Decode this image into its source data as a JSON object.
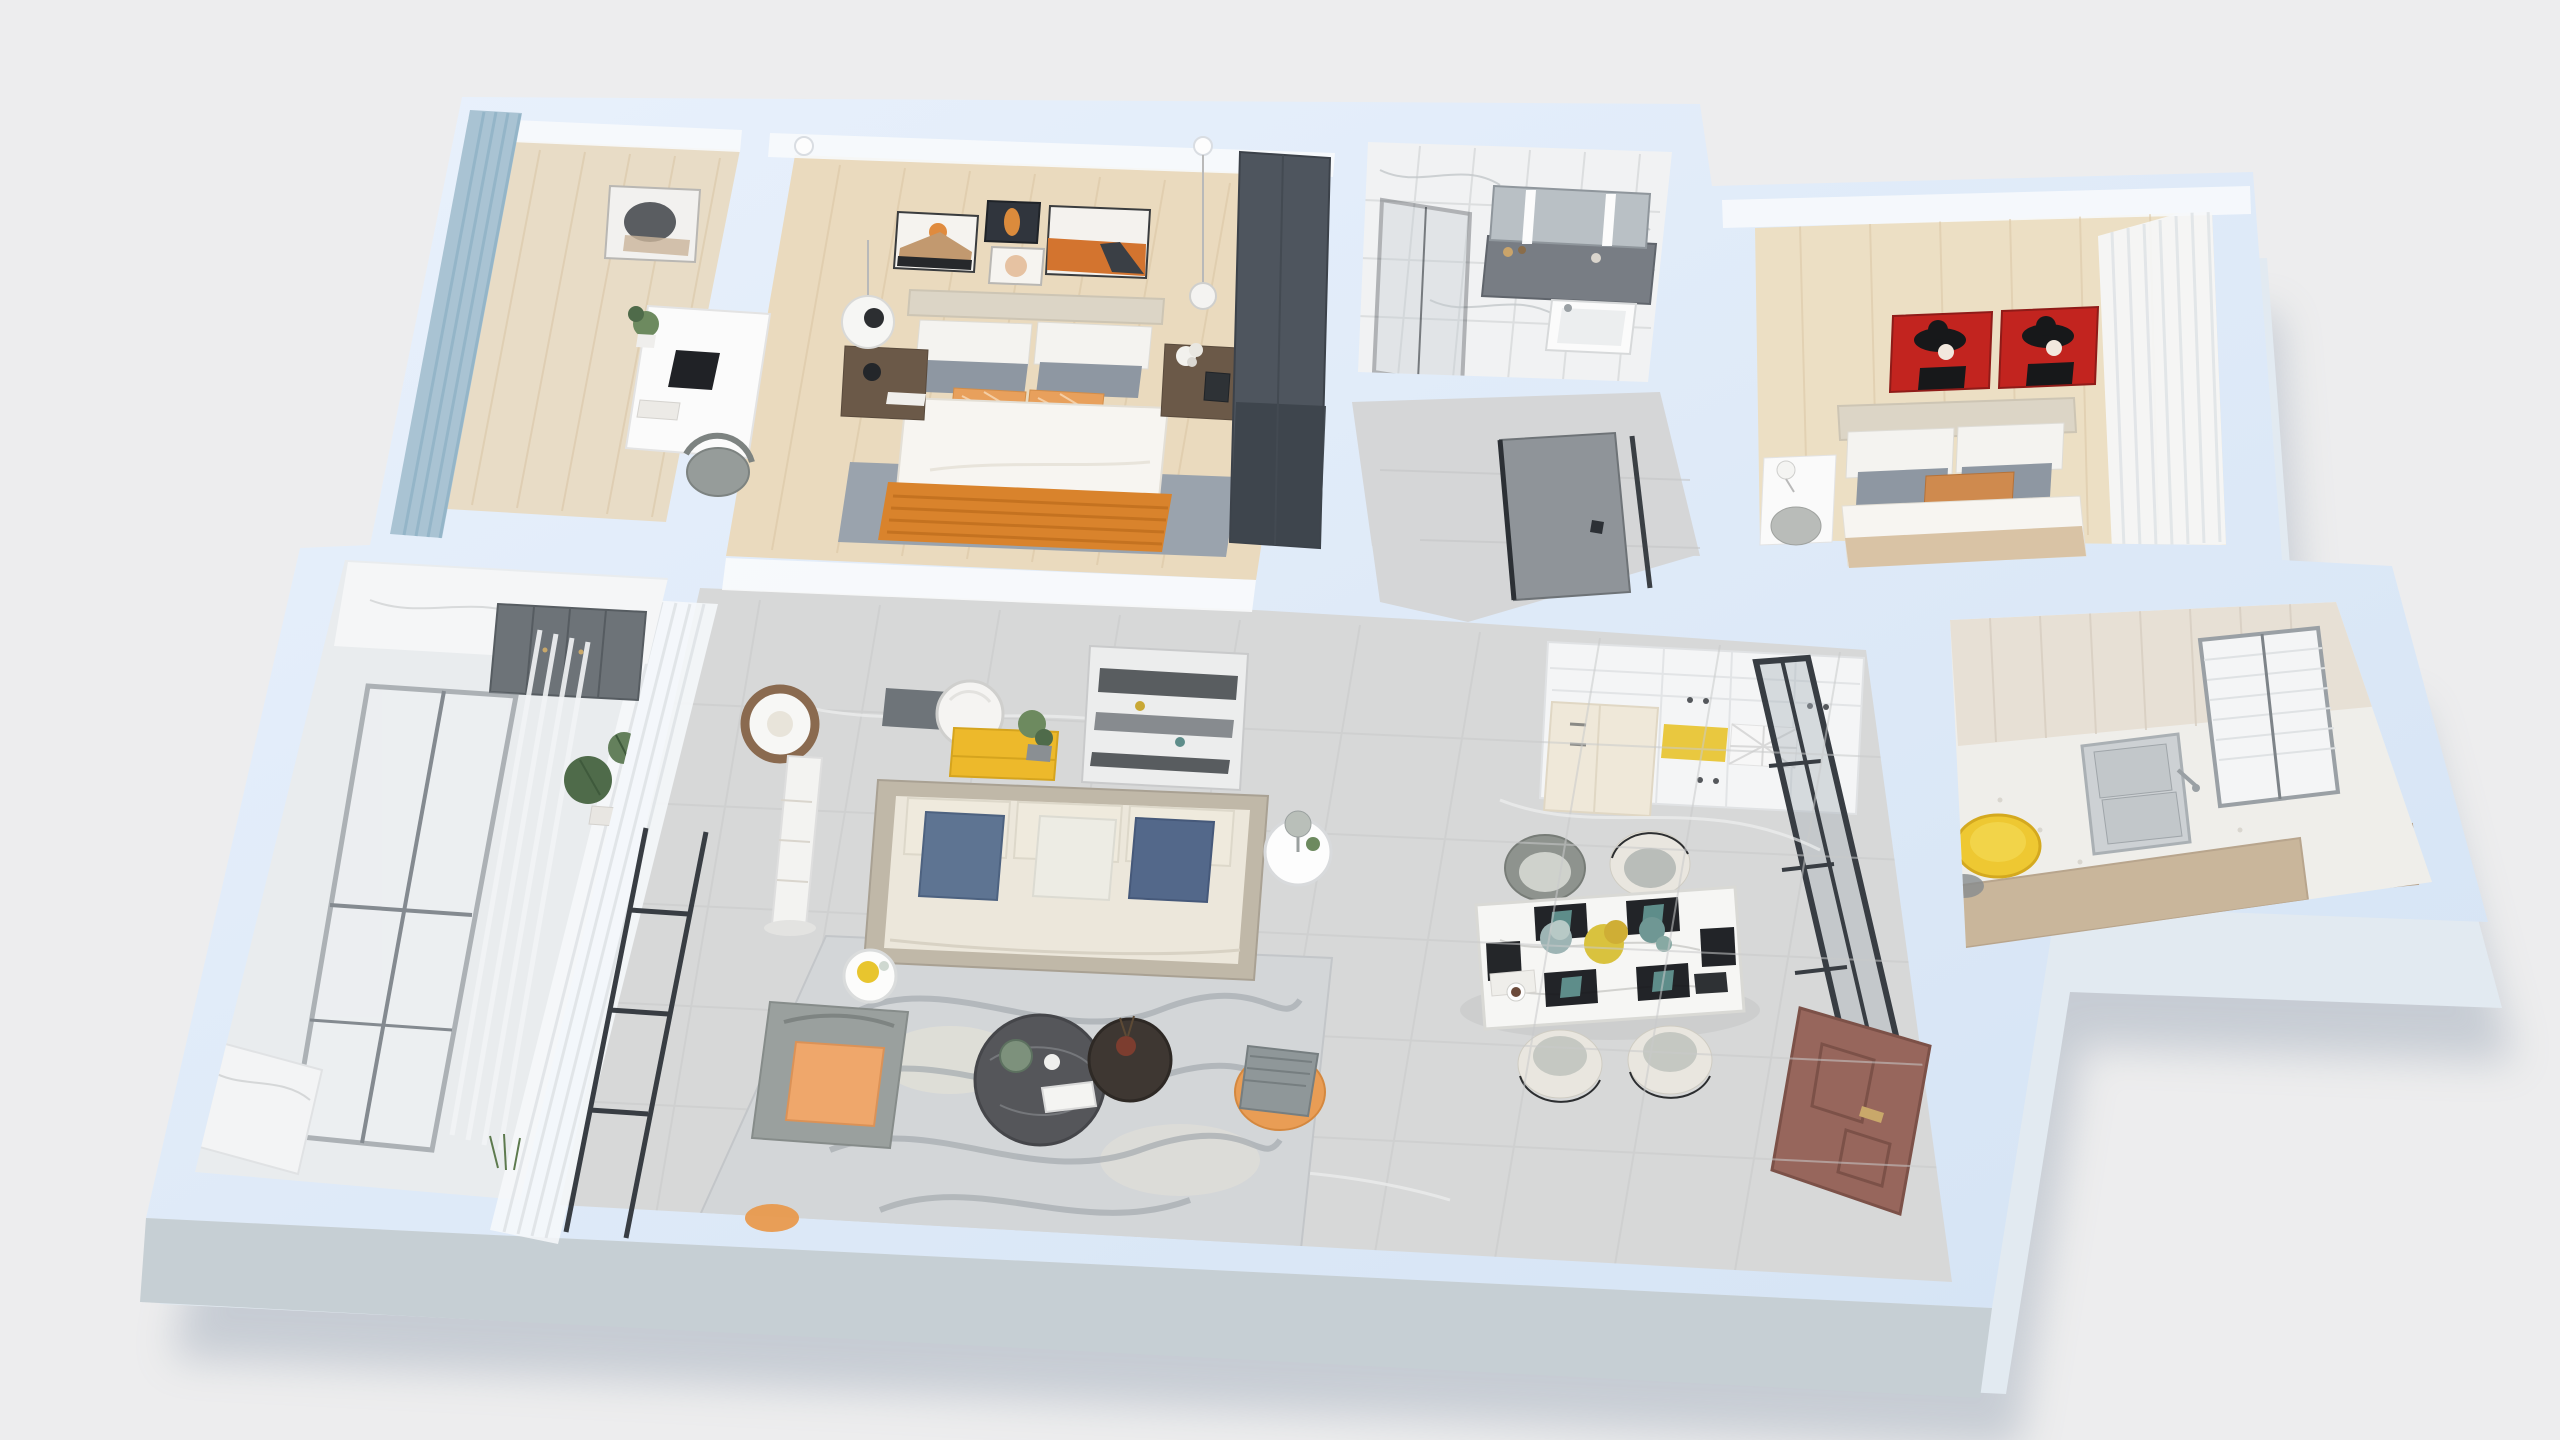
{
  "scene": {
    "kind": "3d-floor-plan-render",
    "view": "isometric top-down apartment rendering",
    "background": "#ededee"
  },
  "palette": {
    "background": "#ededee",
    "wallTopA": "#e9f1fc",
    "wallTopB": "#d4e3f4",
    "wallFace": "#e2eaf1",
    "frontBand": "#c6cfd4",
    "shadow": "#9aa6b5",
    "woodStudy": "#e8dcc6",
    "woodMaster": "#eadabe",
    "woodBedroom2": "#ecdfc4",
    "tile": "#d7d8d8",
    "hallTile": "#d5d6d7",
    "balconyFloor": "#e9ecee",
    "utilityFloor": "#efeeea",
    "marble": "#f1f2f3",
    "curtainBlue": "#a9c3d3",
    "curtainSheer": "rgba(246,248,250,0.88)",
    "wardrobe": "#4e555e",
    "headboard": "#dcd5c6",
    "duvet": "#f7f5f1",
    "pillowGray": "#8e97a2",
    "pillowOrange": "#e8a05c",
    "throwOrange": "#d9832c",
    "rugMaster": "#9aa3ad",
    "rugLiving": "#d3d6d8",
    "rugSwirl": "#a5abb0",
    "sofaShell": "#c0b8a8",
    "sofaBody": "#ece7db",
    "pillowBlue": "#5e7492",
    "pillowBlue2": "#53688a",
    "pillowWhite": "#edece4",
    "consoleYellow": "#edb92b",
    "nicheYellow": "#e9c83f",
    "stoolYellow": "#eec832",
    "plateYellow": "#e8c52e",
    "artRed": "#c2241f",
    "doorBrown": "#97665c",
    "doorGray": "#8f9499",
    "glassFrame": "#383d43",
    "glassPane": "rgba(168,177,185,0.4)",
    "armchair": "#9aa09e",
    "armchairCushion": "#efa76b",
    "pouf": "#e99d55",
    "counterWood": "#c9b69b",
    "steel": "#cdd1d4",
    "tableMarble": "#f6f6f4",
    "chairCream": "#e9e6df",
    "chairSeat": "#b9bdb9",
    "plantGreen": "#4f6b4a",
    "plantLight": "#6d8a5f",
    "lampWood": "#8a6a4f",
    "cabinetWhite": "#f4f5f6",
    "fridgeCream": "#efe8d9",
    "darkPanel": "#6e7479",
    "vanity": "#787d84",
    "mirrorGray": "#b9c0c5"
  },
  "rooms": [
    {
      "id": "study-bedroom",
      "floor": "light wood",
      "furniture": [
        "blue-curtain",
        "window",
        "desk",
        "laptop",
        "chair",
        "wall-art",
        "plant",
        "pendant-light"
      ]
    },
    {
      "id": "master-bedroom",
      "floor": "light wood",
      "furniture": [
        "gallery-wall-art-x4",
        "double-bed",
        "white-gray-orange-pillows",
        "orange-throw",
        "nightstand-left",
        "nightstand-right",
        "disc-lamp",
        "pendant-light",
        "dark-wardrobe",
        "gray-rug"
      ]
    },
    {
      "id": "bathroom",
      "floor": "white marble",
      "furniture": [
        "glass-shower",
        "vanity-counter",
        "led-mirror-cabinet",
        "sink",
        "toiletries"
      ]
    },
    {
      "id": "bedroom-2",
      "floor": "light wood",
      "furniture": [
        "red-portrait-art-x2",
        "double-bed",
        "tan-lumbar-pillow",
        "desk",
        "desk-lamp",
        "stool",
        "sheer-curtains"
      ]
    },
    {
      "id": "laundry-room",
      "floor": "speckled white",
      "furniture": [
        "double-stainless-sink",
        "wood-counter",
        "yellow-stool",
        "window-blinds"
      ]
    },
    {
      "id": "kitchen",
      "furniture": [
        "white-cabinets",
        "cream-fridge",
        "yellow-niche",
        "wine-rack"
      ]
    },
    {
      "id": "dining-area",
      "furniture": [
        "marble-dining-table",
        "black-placemats",
        "teal-napkins",
        "flower-centerpiece",
        "dining-chairs-x4",
        "glass-partition"
      ]
    },
    {
      "id": "hallway",
      "furniture": [
        "gray-interior-door"
      ]
    },
    {
      "id": "entry",
      "furniture": [
        "brown-front-door"
      ]
    },
    {
      "id": "living-room",
      "floor": "gray marble tile",
      "furniture": [
        "three-seat-sofa",
        "blue-pillows",
        "white-pillow",
        "round-coffee-table",
        "small-coffee-table",
        "marbled-rug",
        "ring-floor-lamp",
        "gray-orange-armchair",
        "side-table-lamp",
        "small-round-table",
        "yellow-tv-console",
        "round-mirror",
        "dark-wall-panel",
        "leaning-abstract-art",
        "orange-pouf",
        "sheer-curtain",
        "glass-sliding-door"
      ]
    },
    {
      "id": "balcony",
      "furniture": [
        "gray-frame-windows",
        "sheer-curtains",
        "plants",
        "gray-storage-cabinet",
        "marble-half-wall"
      ]
    }
  ]
}
